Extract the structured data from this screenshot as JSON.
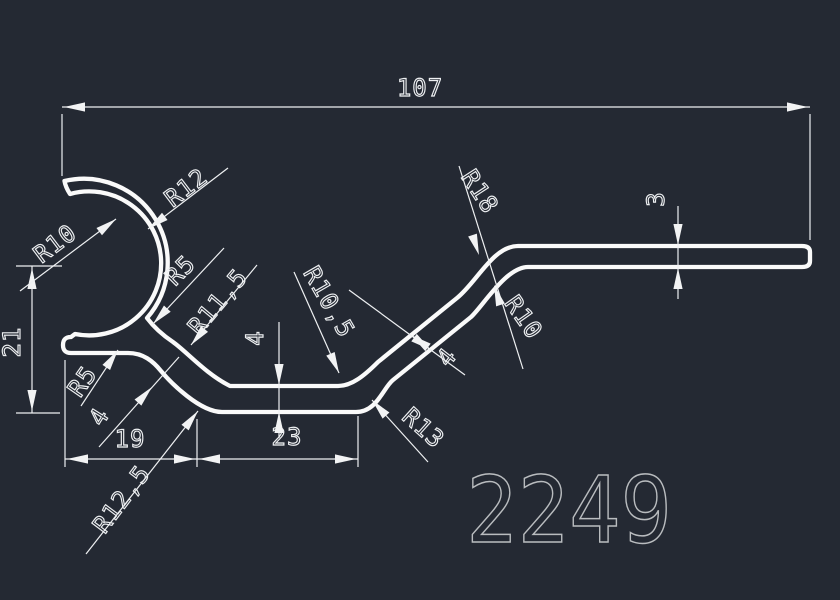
{
  "drawing": {
    "part_number": "2249",
    "units": "mm",
    "background_color": "#242933",
    "line_color": "#fafafa",
    "dimension_color": "#eef0f2",
    "part_number_color": "#b9bcbf",
    "type": "extrusion-profile-cross-section"
  },
  "dimensions": {
    "overall_width": "107",
    "left_height": "21",
    "base_left_segment": "19",
    "base_mid_segment": "23",
    "base_wall_thickness": "4",
    "web_wall_thickness": "4",
    "diagonal_wall_thickness": "4",
    "arm_wall_thickness": "3"
  },
  "radii": {
    "hook_inner": "R10",
    "hook_outer": "R12",
    "hook_web_fillet": "R5",
    "web_base_inner": "R11,5",
    "stub_web_fillet": "R5",
    "base_outer_left": "R12,5",
    "base_inner_right": "R10,5",
    "base_outer_right": "R13",
    "arm_outer": "R18",
    "arm_inner": "R10"
  }
}
